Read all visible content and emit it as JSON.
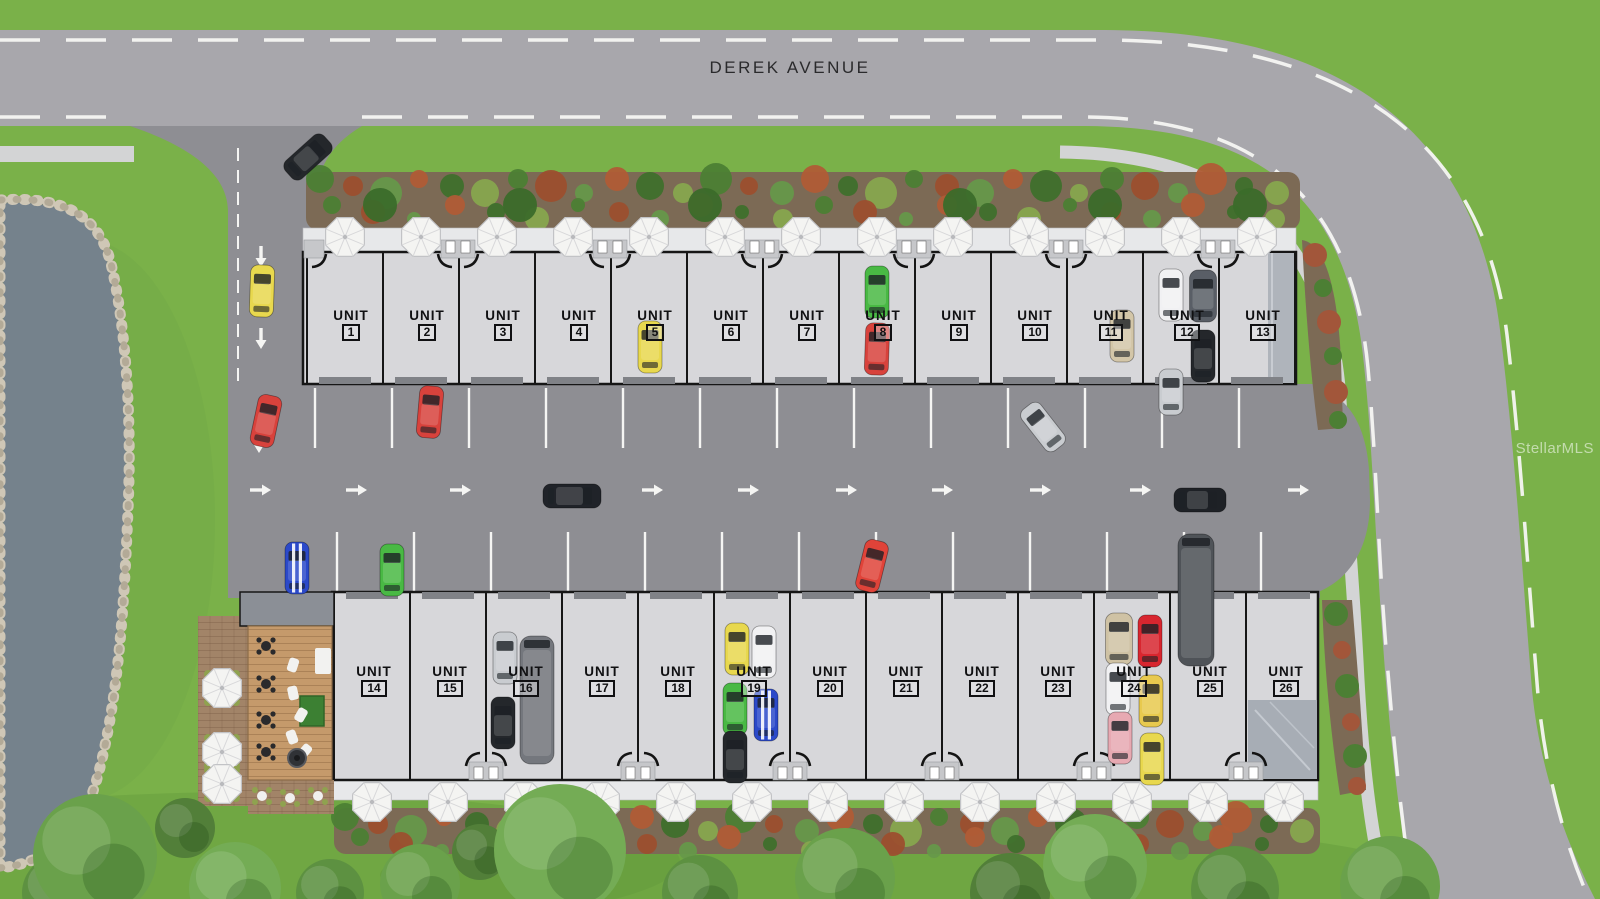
{
  "page": {
    "street_label": "DEREK AVENUE",
    "watermark": "StellarMLS",
    "unit_word": "UNIT"
  },
  "units": {
    "top_row_y": 308,
    "bottom_row_y": 664,
    "top": [
      {
        "n": "1",
        "x": 351
      },
      {
        "n": "2",
        "x": 427
      },
      {
        "n": "3",
        "x": 503
      },
      {
        "n": "4",
        "x": 579
      },
      {
        "n": "5",
        "x": 655
      },
      {
        "n": "6",
        "x": 731
      },
      {
        "n": "7",
        "x": 807
      },
      {
        "n": "8",
        "x": 883
      },
      {
        "n": "9",
        "x": 959
      },
      {
        "n": "10",
        "x": 1035
      },
      {
        "n": "11",
        "x": 1111
      },
      {
        "n": "12",
        "x": 1187
      },
      {
        "n": "13",
        "x": 1263
      }
    ],
    "bottom": [
      {
        "n": "14",
        "x": 374
      },
      {
        "n": "15",
        "x": 450
      },
      {
        "n": "16",
        "x": 526
      },
      {
        "n": "17",
        "x": 602
      },
      {
        "n": "18",
        "x": 678
      },
      {
        "n": "19",
        "x": 754
      },
      {
        "n": "20",
        "x": 830
      },
      {
        "n": "21",
        "x": 906
      },
      {
        "n": "22",
        "x": 982
      },
      {
        "n": "23",
        "x": 1058
      },
      {
        "n": "24",
        "x": 1134
      },
      {
        "n": "25",
        "x": 1210
      },
      {
        "n": "26",
        "x": 1286
      }
    ]
  },
  "lot_markings": {
    "stripes_top": {
      "y1": 388,
      "y2": 448,
      "xs": [
        315,
        392,
        469,
        546,
        623,
        700,
        777,
        854,
        931,
        1008,
        1085,
        1162,
        1239
      ]
    },
    "stripes_bottom": {
      "y1": 532,
      "y2": 594,
      "xs": [
        337,
        414,
        491,
        568,
        645,
        722,
        799,
        876,
        953,
        1030,
        1107,
        1184,
        1261
      ]
    },
    "arrows_right": {
      "y": 490,
      "xs": [
        260,
        356,
        460,
        652,
        748,
        846,
        942,
        1040,
        1140,
        1298
      ]
    },
    "arrows_down": [
      [
        261,
        256
      ],
      [
        261,
        338
      ],
      [
        259,
        442
      ]
    ]
  },
  "cars": [
    {
      "x": 308,
      "y": 157,
      "r": 48,
      "c": "#24272b"
    },
    {
      "x": 262,
      "y": 291,
      "r": 2,
      "c": "#e8d84e"
    },
    {
      "x": 266,
      "y": 421,
      "r": 12,
      "c": "#d8423c"
    },
    {
      "x": 430,
      "y": 412,
      "r": 5,
      "c": "#d8423c"
    },
    {
      "x": 650,
      "y": 347,
      "r": 0,
      "c": "#e8d84e"
    },
    {
      "x": 877,
      "y": 292,
      "r": 0,
      "c": "#49b944"
    },
    {
      "x": 877,
      "y": 349,
      "r": 2,
      "c": "#d8423c"
    },
    {
      "x": 1122,
      "y": 336,
      "r": 0,
      "c": "#d3c6a8"
    },
    {
      "x": 1171,
      "y": 295,
      "r": 0,
      "c": "#f1f1f3"
    },
    {
      "x": 1203,
      "y": 296,
      "r": 0,
      "c": "#595e66",
      "w": 27
    },
    {
      "x": 1203,
      "y": 356,
      "r": 0,
      "c": "#24272b"
    },
    {
      "x": 1171,
      "y": 392,
      "r": 0,
      "c": "#c9ccd0",
      "l": 46
    },
    {
      "x": 1043,
      "y": 427,
      "r": -38,
      "c": "#c9ccd0"
    },
    {
      "x": 572,
      "y": 496,
      "r": 90,
      "c": "#202329",
      "l": 58
    },
    {
      "x": 1200,
      "y": 500,
      "r": 90,
      "c": "#1e2126"
    },
    {
      "x": 1196,
      "y": 600,
      "r": 0,
      "c": "#4f5358",
      "k": "van",
      "l": 132,
      "w": 36
    },
    {
      "x": 297,
      "y": 568,
      "r": 0,
      "c": "#2b49c9",
      "s": 1
    },
    {
      "x": 392,
      "y": 570,
      "r": 0,
      "c": "#49b944"
    },
    {
      "x": 872,
      "y": 566,
      "r": 14,
      "c": "#e04339"
    },
    {
      "x": 505,
      "y": 658,
      "r": 0,
      "c": "#c9ccd0"
    },
    {
      "x": 503,
      "y": 723,
      "r": 0,
      "c": "#24272b"
    },
    {
      "x": 537,
      "y": 700,
      "r": 0,
      "c": "#74777d",
      "k": "van",
      "l": 128,
      "w": 34
    },
    {
      "x": 737,
      "y": 649,
      "r": 0,
      "c": "#e8d84e"
    },
    {
      "x": 764,
      "y": 652,
      "r": 0,
      "c": "#f1f1f3"
    },
    {
      "x": 735,
      "y": 709,
      "r": 0,
      "c": "#49b944"
    },
    {
      "x": 766,
      "y": 715,
      "r": 0,
      "c": "#2b49c9",
      "s": 1
    },
    {
      "x": 735,
      "y": 757,
      "r": 0,
      "c": "#24272b"
    },
    {
      "x": 1119,
      "y": 639,
      "r": 0,
      "c": "#cfc2a4",
      "w": 27
    },
    {
      "x": 1150,
      "y": 641,
      "r": 0,
      "c": "#d8262f"
    },
    {
      "x": 1118,
      "y": 689,
      "r": 0,
      "c": "#f1f1f3"
    },
    {
      "x": 1151,
      "y": 701,
      "r": 0,
      "c": "#e8c94e"
    },
    {
      "x": 1120,
      "y": 738,
      "r": 0,
      "c": "#e7a9b2"
    },
    {
      "x": 1152,
      "y": 759,
      "r": 0,
      "c": "#e8d84e"
    }
  ],
  "trees": [
    {
      "x": 60,
      "y": 893,
      "r": 38
    },
    {
      "x": 95,
      "y": 856,
      "r": 62
    },
    {
      "x": 185,
      "y": 828,
      "r": 30
    },
    {
      "x": 235,
      "y": 888,
      "r": 46
    },
    {
      "x": 330,
      "y": 893,
      "r": 34
    },
    {
      "x": 420,
      "y": 884,
      "r": 40
    },
    {
      "x": 480,
      "y": 852,
      "r": 28
    },
    {
      "x": 560,
      "y": 850,
      "r": 66
    },
    {
      "x": 700,
      "y": 893,
      "r": 38
    },
    {
      "x": 845,
      "y": 878,
      "r": 50
    },
    {
      "x": 1010,
      "y": 893,
      "r": 40
    },
    {
      "x": 1095,
      "y": 866,
      "r": 52
    },
    {
      "x": 1235,
      "y": 890,
      "r": 44
    },
    {
      "x": 1390,
      "y": 886,
      "r": 50
    }
  ],
  "patio_umbrellas": [
    [
      222,
      688
    ],
    [
      222,
      752
    ],
    [
      222,
      784
    ]
  ],
  "colors": {
    "grass": "#7ab149",
    "road": "#a8a7ac",
    "lot": "#8e8e93",
    "building": "#d7d7da",
    "trim": "#e7e8ea",
    "pond": "#75828c",
    "deck_wood": "#c59a6b",
    "soil": "#7c6a55",
    "outline": "#161616",
    "marking_white": "#f5f5f3"
  }
}
